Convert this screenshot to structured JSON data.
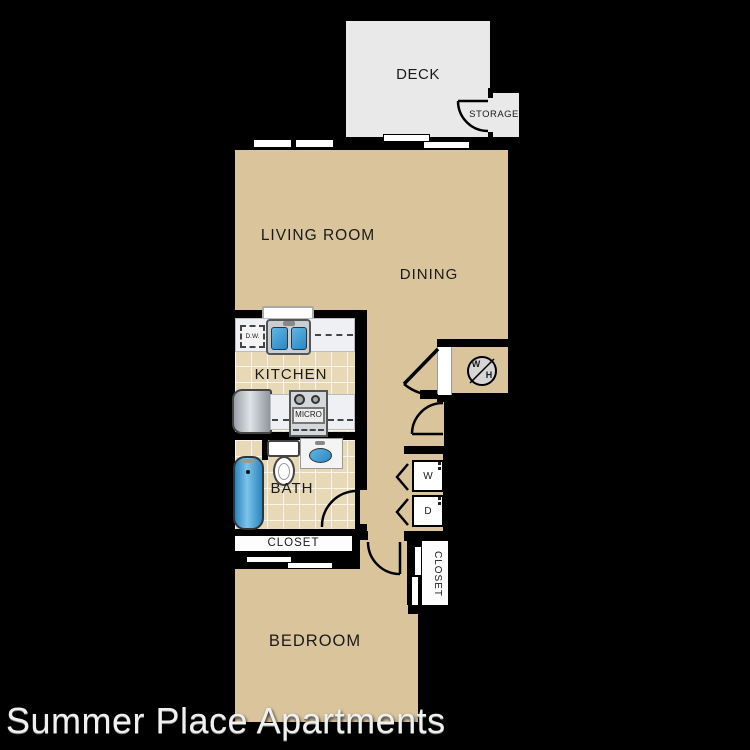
{
  "watermark": {
    "text": "Summer Place Apartments"
  },
  "rooms": {
    "deck": "DECK",
    "storage": "STORAGE",
    "living_room": "LIVING ROOM",
    "dining": "DINING",
    "kitchen": "KITCHEN",
    "bath": "BATH",
    "closet_hall": "CLOSET",
    "closet_bedroom": "CLOSET",
    "bedroom": "BEDROOM"
  },
  "appliances": {
    "dishwasher": "D.W.",
    "microwave": "MICRO",
    "washer": "W",
    "dryer": "D",
    "water_heater_w": "W",
    "water_heater_h": "H"
  },
  "colors": {
    "background": "#000000",
    "wall": "#000000",
    "floor": "#d9c49c",
    "tile": "#e8d9b6",
    "deck": "#e9e9e9",
    "counter": "#eef0f3",
    "fixture_blue": "#3f9fd4",
    "watermark_text": "#f0f0f0"
  }
}
